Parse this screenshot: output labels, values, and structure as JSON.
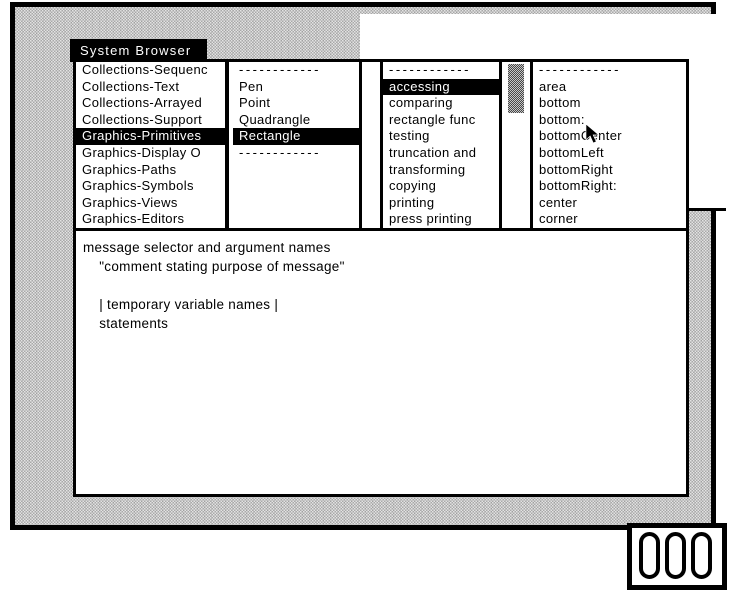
{
  "colors": {
    "ink": "#000000",
    "paper": "#ffffff",
    "desktop_gray": "#c0c0c0"
  },
  "window": {
    "title": "System Browser",
    "category_pane": {
      "items": [
        {
          "label": "Collections-Sequenc",
          "selected": false
        },
        {
          "label": "Collections-Text",
          "selected": false
        },
        {
          "label": "Collections-Arrayed",
          "selected": false
        },
        {
          "label": "Collections-Support",
          "selected": false
        },
        {
          "label": "Graphics-Primitives",
          "selected": true
        },
        {
          "label": "Graphics-Display O",
          "selected": false
        },
        {
          "label": "Graphics-Paths",
          "selected": false
        },
        {
          "label": "Graphics-Symbols",
          "selected": false
        },
        {
          "label": "Graphics-Views",
          "selected": false
        },
        {
          "label": "Graphics-Editors",
          "selected": false
        }
      ]
    },
    "class_pane": {
      "items": [
        {
          "label": "------------",
          "separator": true
        },
        {
          "label": "Pen",
          "selected": false
        },
        {
          "label": "Point",
          "selected": false
        },
        {
          "label": "Quadrangle",
          "selected": false
        },
        {
          "label": "Rectangle",
          "selected": true
        },
        {
          "label": "------------",
          "separator": true
        }
      ]
    },
    "protocol_pane": {
      "items": [
        {
          "label": "------------",
          "separator": true
        },
        {
          "label": "accessing",
          "selected": true
        },
        {
          "label": "comparing",
          "selected": false
        },
        {
          "label": "rectangle func",
          "selected": false
        },
        {
          "label": "testing",
          "selected": false
        },
        {
          "label": "truncation and",
          "selected": false
        },
        {
          "label": "transforming",
          "selected": false
        },
        {
          "label": "copying",
          "selected": false
        },
        {
          "label": "printing",
          "selected": false
        },
        {
          "label": "press printing",
          "selected": false
        }
      ]
    },
    "selector_pane": {
      "items": [
        {
          "label": "------------",
          "separator": true
        },
        {
          "label": "area",
          "selected": false
        },
        {
          "label": "bottom",
          "selected": false
        },
        {
          "label": "bottom:",
          "selected": false
        },
        {
          "label": "bottomCenter",
          "selected": false
        },
        {
          "label": "bottomLeft",
          "selected": false
        },
        {
          "label": "bottomRight",
          "selected": false
        },
        {
          "label": "bottomRight:",
          "selected": false
        },
        {
          "label": "center",
          "selected": false
        },
        {
          "label": "corner",
          "selected": false
        }
      ]
    },
    "buttons": {
      "instance_label": "instance",
      "class_label": "class"
    },
    "code_pane": {
      "lines": [
        "message selector and argument names",
        "    \"comment stating purpose of message\"",
        "",
        "    | temporary variable names |",
        "    statements"
      ]
    }
  }
}
